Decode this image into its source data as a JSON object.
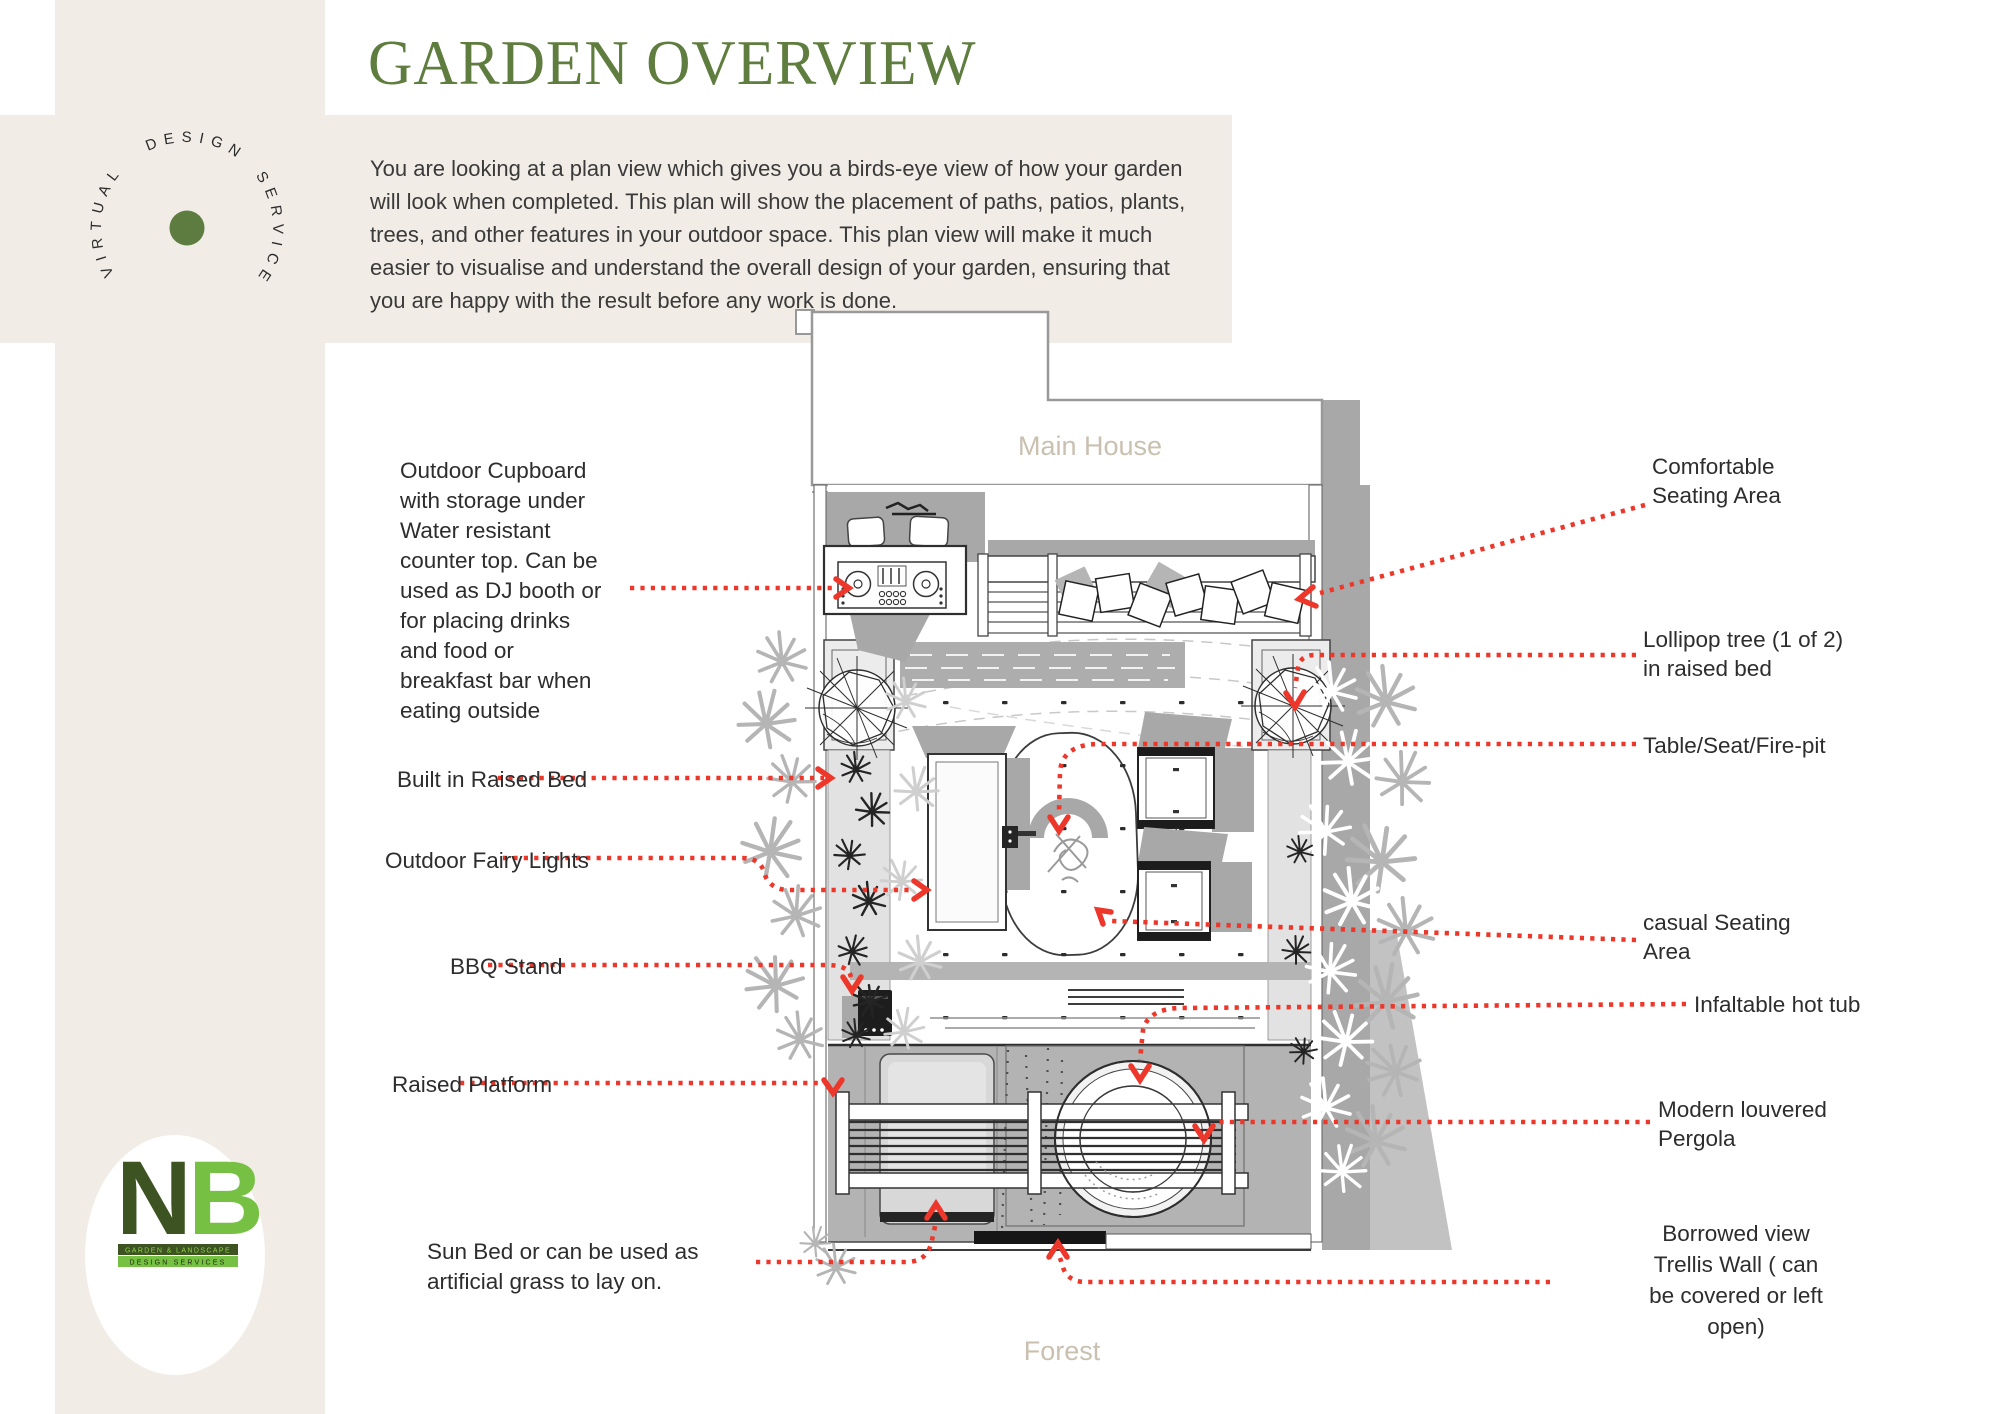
{
  "title": "GARDEN OVERVIEW",
  "badge": {
    "word1": "VIRTUAL",
    "word2": "DESIGN",
    "word3": "SERVICE"
  },
  "description": {
    "lines": [
      "You are looking at a plan view which gives you a birds-eye view of how your garden",
      "will look when completed. This plan will show the placement of paths, patios, plants,",
      "trees, and other features in your outdoor space. This plan view will make it much",
      "easier to visualise and understand the overall design of your garden, ensuring that",
      "you are happy with the result before any work is done."
    ]
  },
  "plan": {
    "top_label": "Main House",
    "bottom_label": "Forest"
  },
  "annotations": {
    "left": [
      {
        "name": "outdoor-cupboard",
        "lines": [
          "Outdoor Cupboard",
          "with storage under",
          "Water resistant",
          "counter top. Can be",
          "used as DJ booth or",
          "for placing drinks",
          "and food or",
          "breakfast bar when",
          "eating outside"
        ]
      },
      {
        "name": "built-in-raised-bed",
        "lines": [
          "Built in Raised Bed"
        ]
      },
      {
        "name": "outdoor-fairy-lights",
        "lines": [
          "Outdoor Fairy Lights"
        ]
      },
      {
        "name": "bbq-stand",
        "lines": [
          "BBQ Stand"
        ]
      },
      {
        "name": "raised-platform",
        "lines": [
          "Raised Platform"
        ]
      },
      {
        "name": "sun-bed",
        "lines": [
          "Sun Bed or can be used as",
          "artificial grass to lay on."
        ]
      }
    ],
    "right": [
      {
        "name": "comfortable-seating",
        "lines": [
          "Comfortable",
          "Seating Area"
        ]
      },
      {
        "name": "lollipop-tree",
        "lines": [
          "Lollipop tree (1 of 2)",
          "in raised bed"
        ]
      },
      {
        "name": "table-seat-firepit",
        "lines": [
          "Table/Seat/Fire-pit"
        ]
      },
      {
        "name": "casual-seating",
        "lines": [
          "casual Seating",
          "Area"
        ]
      },
      {
        "name": "inflatable-hot-tub",
        "lines": [
          "Infaltable hot tub"
        ]
      },
      {
        "name": "louvered-pergola",
        "lines": [
          "Modern louvered",
          "Pergola"
        ]
      },
      {
        "name": "borrowed-view-trellis",
        "lines": [
          "Borrowed view",
          "Trellis Wall ( can",
          "be covered or left",
          "open)"
        ]
      }
    ]
  },
  "brand": {
    "monogram_n": "N",
    "monogram_b": "B",
    "bar1": "GARDEN & LANDSCAPE",
    "bar2": "DESIGN SERVICES"
  },
  "colors": {
    "accent_red": "#ee372b",
    "title_green": "#5f7d3e",
    "badge_dot_green": "#5d7c40",
    "brand_dark_green": "#3d5321",
    "brand_light_green": "#76c043",
    "beige": "#f1ece6",
    "plan_shadow_gray": "#a8a8a8",
    "plan_label_gray": "#c9c0b0",
    "text_dark": "#2d2d2d"
  }
}
